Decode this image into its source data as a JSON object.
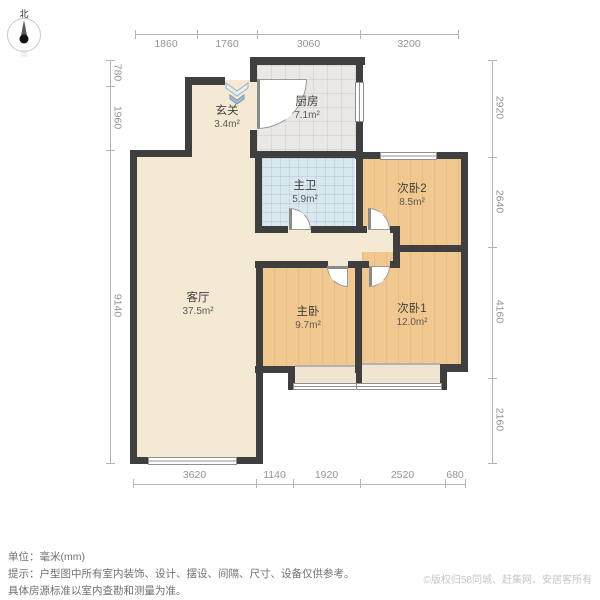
{
  "compass": {
    "north": "北",
    "south": "南"
  },
  "dims": {
    "top": [
      "1860",
      "1760",
      "3060",
      "3200"
    ],
    "left": [
      "780",
      "1960",
      "9140"
    ],
    "right": [
      "2920",
      "2640",
      "4160",
      "2160"
    ],
    "bottom": [
      "3620",
      "1140",
      "1920",
      "2520",
      "680"
    ]
  },
  "rooms": [
    {
      "id": "xuanguan",
      "name": "玄关",
      "area": "3.4m²"
    },
    {
      "id": "kitchen",
      "name": "厨房",
      "area": "7.1m²"
    },
    {
      "id": "bath",
      "name": "主卫",
      "area": "5.9m²"
    },
    {
      "id": "bedroom2",
      "name": "次卧2",
      "area": "8.5m²"
    },
    {
      "id": "living",
      "name": "客厅",
      "area": "37.5m²"
    },
    {
      "id": "master",
      "name": "主卧",
      "area": "9.7m²"
    },
    {
      "id": "bedroom1",
      "name": "次卧1",
      "area": "12.0m²"
    }
  ],
  "footer": {
    "unit_line": "单位：毫米(mm)",
    "tip_line1": "提示：户型图中所有室内装饰、设计、摆设、间隔、尺寸、设备仅供参考。",
    "tip_line2": "具体房源标准以室内查勘和测量为准。",
    "copyright": "©版权归58同城、赶集网、安居客所有"
  },
  "colors": {
    "wall": "#3f3f3f",
    "living_floor": "#f4e9d2",
    "wood_floor": "#f1c88f",
    "kitchen_floor": "#eae8e4",
    "bath_floor": "#d9e8ef",
    "bay_floor": "#efe5d2",
    "dim_text": "#949494",
    "label_text": "#3f3f3f",
    "footer_text": "#707070",
    "copyright_text": "#c6c6c6",
    "arrow_blue": "#9fbccf"
  }
}
